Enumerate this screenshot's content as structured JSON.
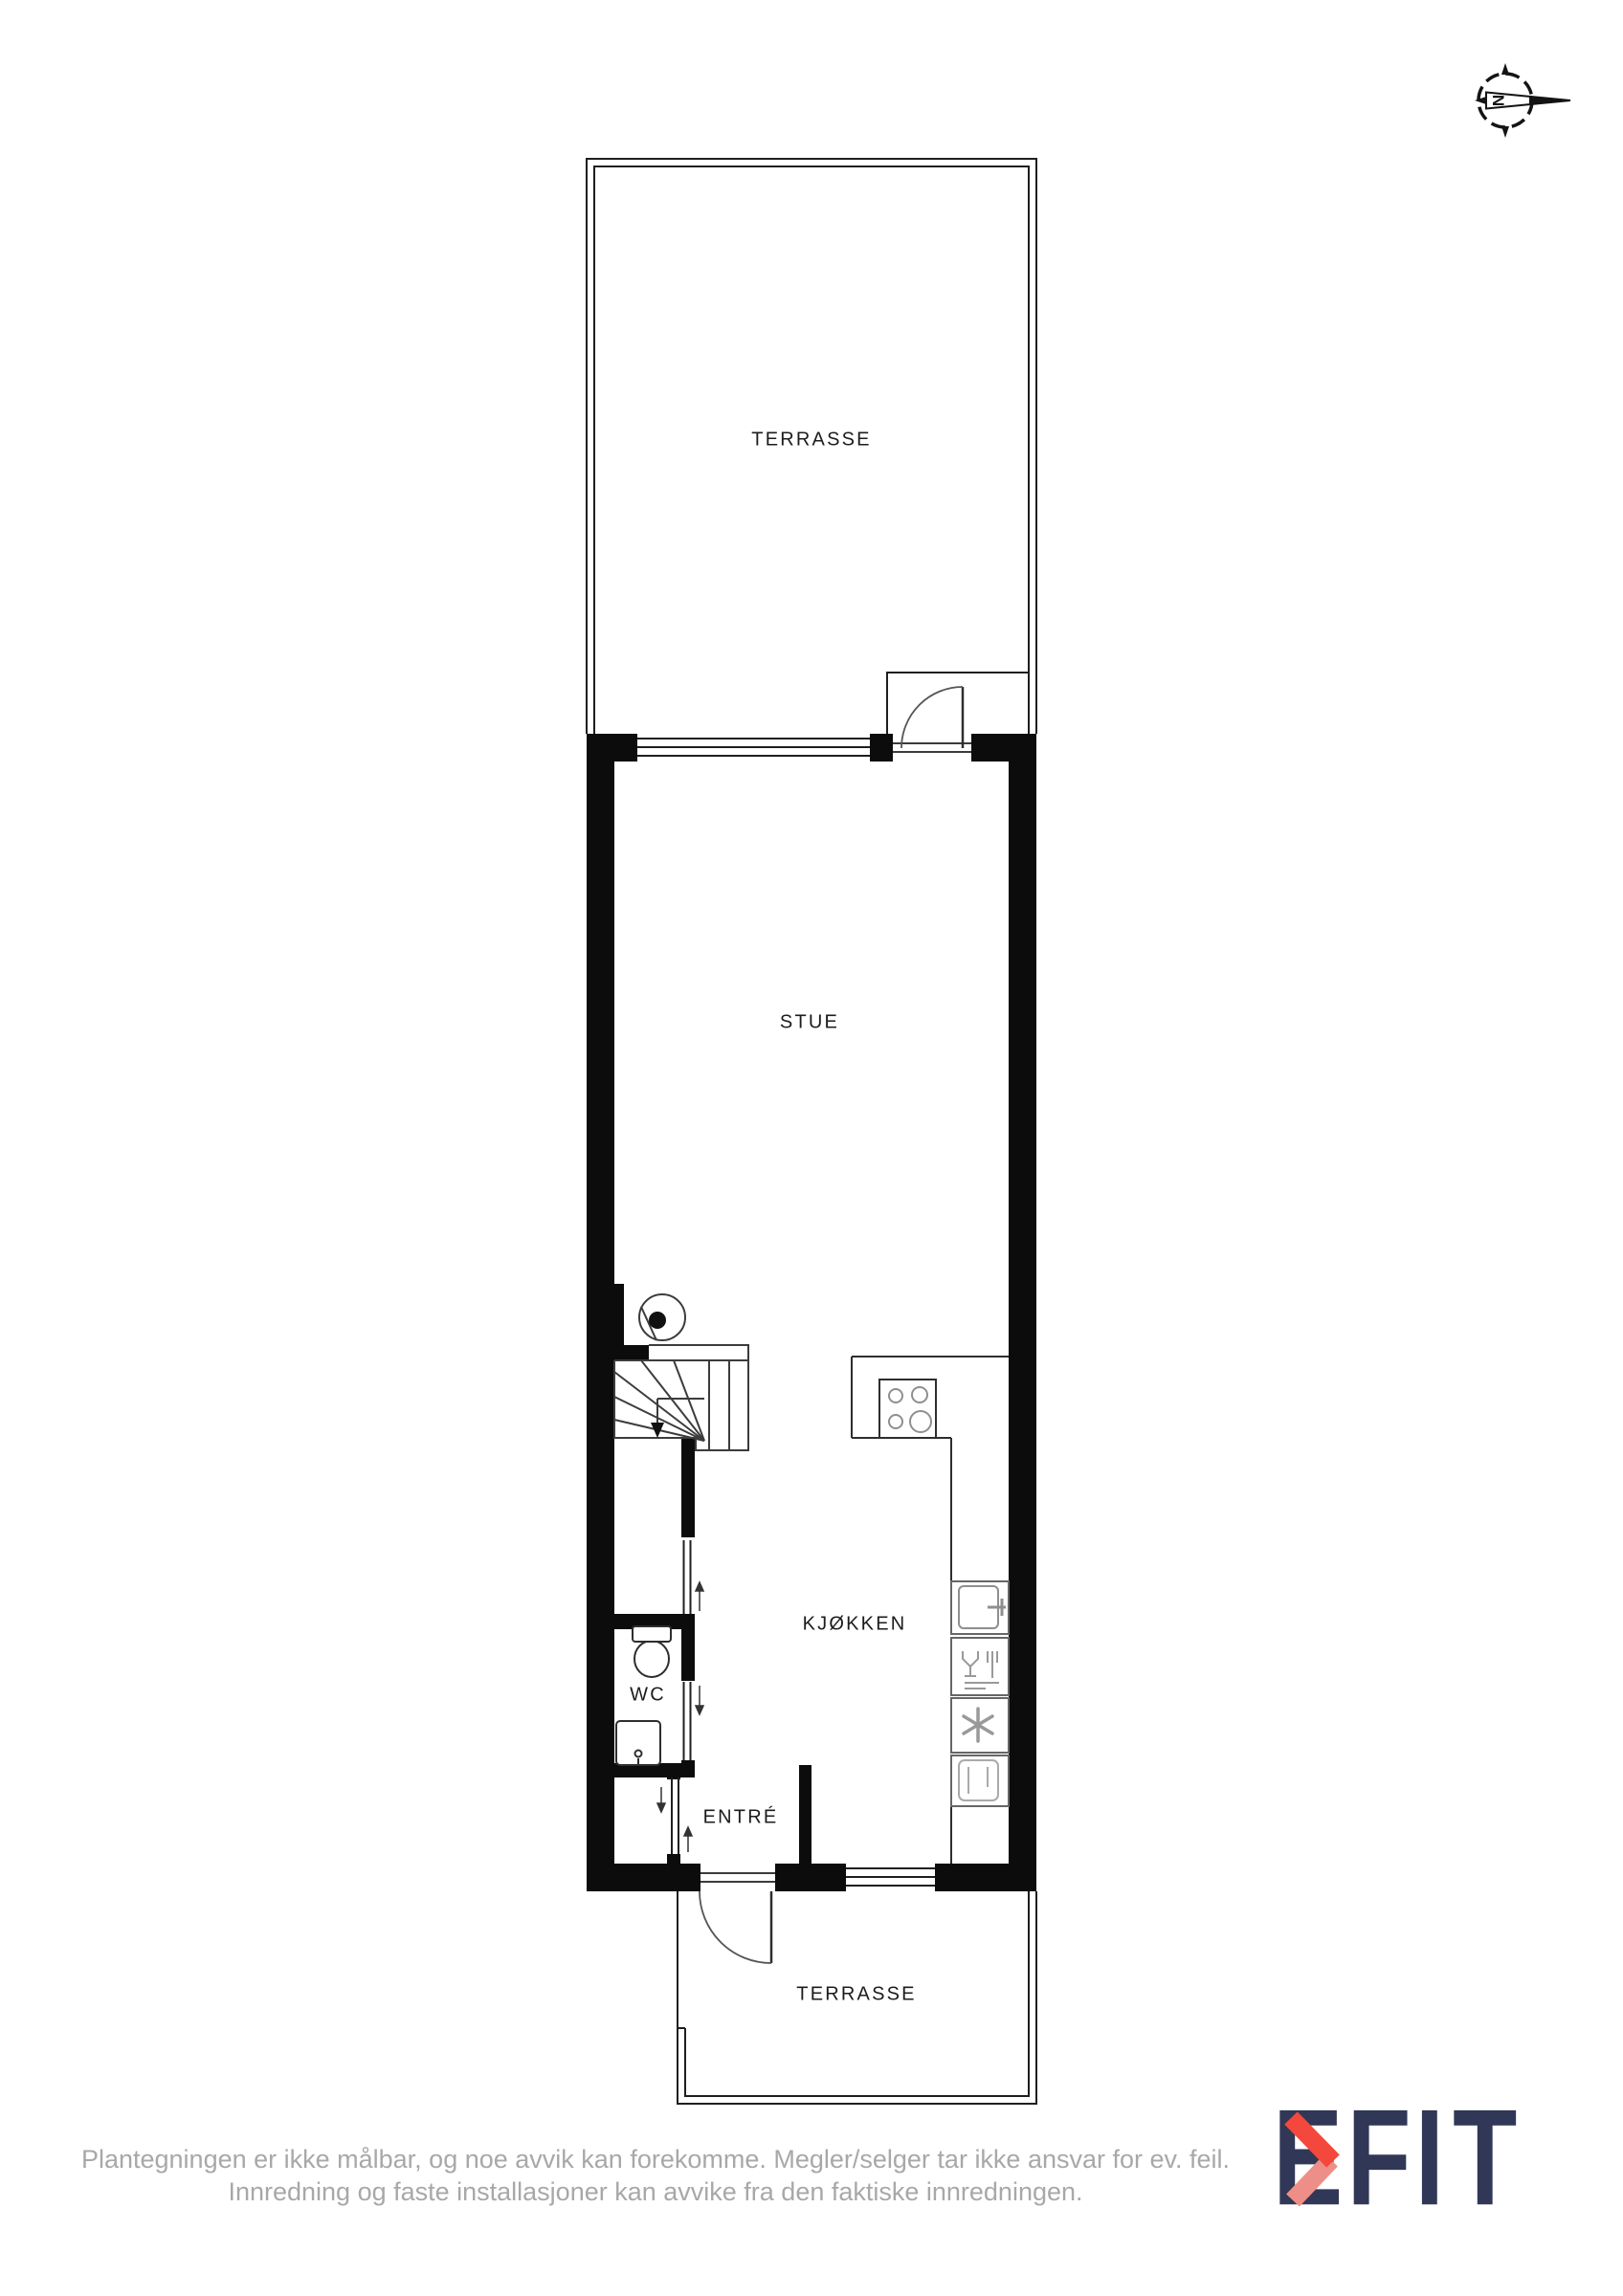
{
  "page": {
    "background_color": "#ffffff"
  },
  "floor_plan": {
    "compass": {
      "north_letter": "N"
    },
    "rooms": {
      "terrace_top": "TERRASSE",
      "stue": "STUE",
      "kjokken": "KJØKKEN",
      "wc": "WC",
      "entre": "ENTRÉ",
      "terrace_bottom": "TERRASSE"
    },
    "colors": {
      "wall": "#0c0c0c",
      "thin_line": "#1f1f1f",
      "fixture_line": "#2e2e2e",
      "appliance_line": "#8f8f8f",
      "label": "#1c1c1c"
    }
  },
  "footer": {
    "disclaimer_line1": "Plantegningen er ikke målbar, og noe avvik kan forekomme. Megler/selger tar ikke ansvar for ev. feil.",
    "disclaimer_line2": "Innredning og faste installasjoner kan avvike fra den faktiske innredningen.",
    "text_color": "#a8a8a8"
  },
  "logo": {
    "brand": "EFKT",
    "left_text": "EF",
    "right_text": "IT",
    "navy": "#313756",
    "red": "#f4483d",
    "pink": "#ee8e88"
  }
}
